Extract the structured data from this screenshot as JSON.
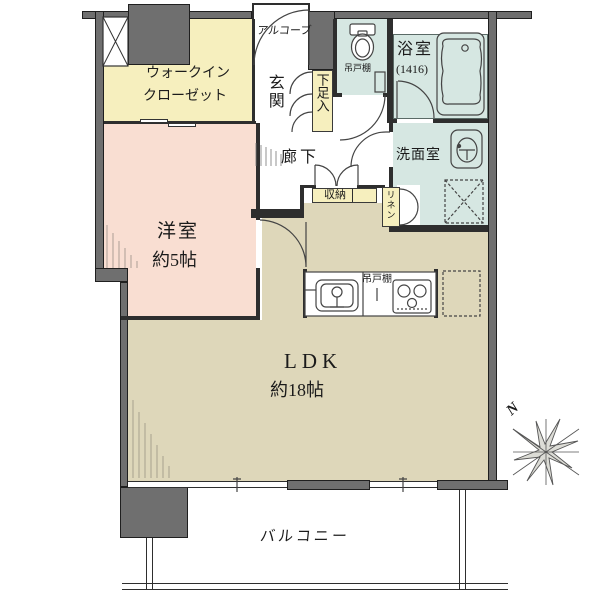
{
  "plan_title": "1LDK floor plan",
  "rooms": {
    "walk_in_closet": {
      "label_line1": "ウォークイン",
      "label_line2": "クローゼット"
    },
    "alcove": {
      "label": "アルコーブ"
    },
    "entrance": {
      "label": "玄関"
    },
    "shoe_cabinet": {
      "label": "下足入"
    },
    "corridor": {
      "label": "廊下"
    },
    "toilet": {
      "shelf_label": "吊戸棚"
    },
    "bathroom": {
      "label": "浴室",
      "size": "(1416)"
    },
    "washroom": {
      "label": "洗面室"
    },
    "storage": {
      "label": "収納"
    },
    "linen": {
      "label": "リネン"
    },
    "bedroom": {
      "label": "洋室",
      "size": "約5帖"
    },
    "ldk": {
      "label": "LDK",
      "size": "約18帖"
    },
    "kitchen": {
      "shelf_label": "吊戸棚"
    },
    "balcony": {
      "label": "バルコニー"
    }
  },
  "compass": {
    "label": "N"
  },
  "colors": {
    "wall": "#6f6f6f",
    "closet_yellow": "#f6efbe",
    "bedroom_pink": "#f9ded2",
    "wet_area_blue": "#d6e7e2",
    "ldk_beige": "#ded7ba"
  }
}
